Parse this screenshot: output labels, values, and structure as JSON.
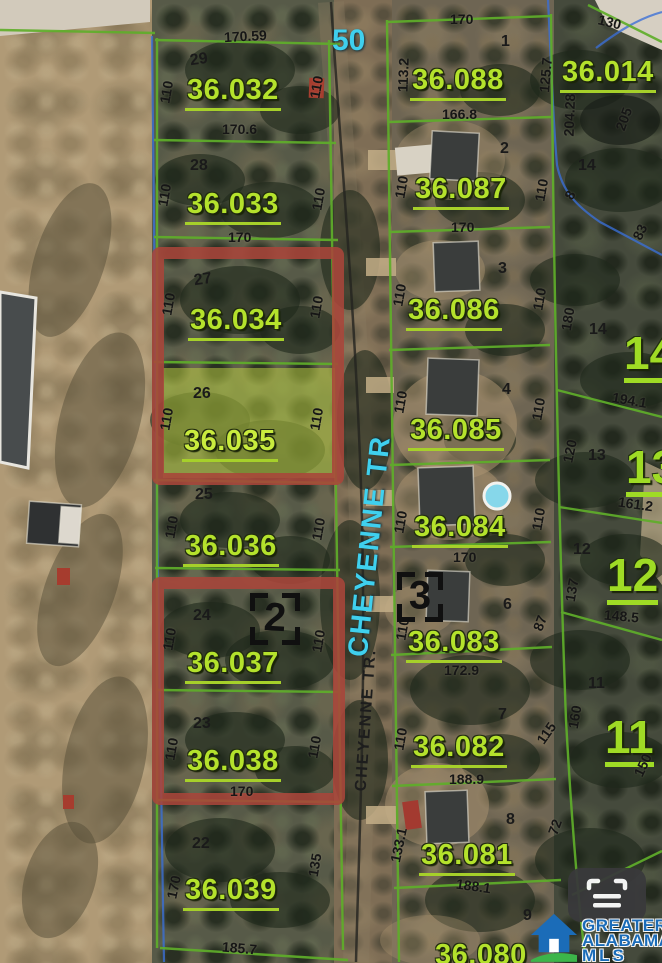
{
  "street": {
    "label_large": "CHEYENNE TR",
    "label_small": "CHEYENNE TR.",
    "width": "50"
  },
  "markers": {
    "m2": "2",
    "m3": "3"
  },
  "left_lots": [
    {
      "apn": "36.032",
      "lot": "29",
      "top": "170.59",
      "left": "110",
      "right": "110"
    },
    {
      "apn": "36.033",
      "lot": "28",
      "top": "170.6",
      "left": "110",
      "right": "110"
    },
    {
      "apn": "36.034",
      "lot": "27",
      "top": "170",
      "left": "110",
      "right": "110"
    },
    {
      "apn": "36.035",
      "lot": "26",
      "left": "110",
      "right": "110"
    },
    {
      "apn": "36.036",
      "lot": "25",
      "left": "110",
      "right": "110"
    },
    {
      "apn": "36.037",
      "lot": "24",
      "left": "110",
      "right": "110"
    },
    {
      "apn": "36.038",
      "lot": "23",
      "left": "110",
      "right": "110",
      "bottom": "170"
    },
    {
      "apn": "36.039",
      "lot": "22",
      "left": "170",
      "right": "135",
      "bottom": "185.7"
    }
  ],
  "right_lots": [
    {
      "apn": "36.088",
      "lot": "1",
      "top": "170",
      "left": "113.2",
      "right": "125.7",
      "bottom": "166.8"
    },
    {
      "apn": "36.087",
      "lot": "2",
      "left": "110",
      "right": "110",
      "bottom": "170"
    },
    {
      "apn": "36.086",
      "lot": "3",
      "left": "110",
      "right": "110"
    },
    {
      "apn": "36.085",
      "lot": "4",
      "left": "110",
      "right": "110"
    },
    {
      "apn": "36.084",
      "left": "110",
      "right": "110",
      "bottom": "170"
    },
    {
      "apn": "36.083",
      "lot": "6",
      "left": "110",
      "right": "87",
      "bottom": "172.9"
    },
    {
      "apn": "36.082",
      "lot": "7",
      "left": "110",
      "right": "115",
      "bottom": "188.9"
    },
    {
      "apn": "36.081",
      "lot": "8",
      "left": "133.1",
      "right": "72",
      "bottom": "188.1"
    },
    {
      "apn": "36.080",
      "lot": "9"
    }
  ],
  "outer": {
    "apn": "36.014",
    "n130": "130",
    "n20428": "204.28",
    "n205": "205",
    "n14": "14",
    "n8": "8",
    "n83": "83",
    "n180": "180",
    "lot14": "14",
    "big14": "14",
    "n1941": "194.1",
    "lot13": "13",
    "big13": "13",
    "n120": "120",
    "n1612": "161.2",
    "lot12": "12",
    "big12": "12",
    "n137": "137",
    "n1485": "148.5",
    "lot11": "11",
    "big11": "11",
    "n160": "160",
    "n150": "150"
  },
  "watermark": {
    "line1": "GREATER",
    "line2": "ALABAMA",
    "line3": "MLS"
  },
  "colors": {
    "parcel_label": "#b4e22c",
    "street_label": "#3fd0ee",
    "highlight_outline": "#a8453a",
    "highlight_fill": "#b9cf3f",
    "boundary_green": "#5fae2a",
    "boundary_blue": "#3a6fd8",
    "logo_blue": "#1b6cb8",
    "logo_green": "#3cb54a"
  }
}
